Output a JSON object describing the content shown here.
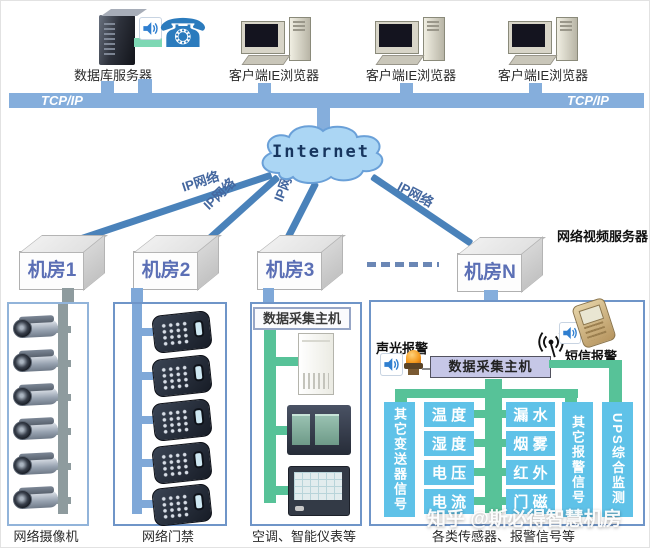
{
  "header": {
    "db_server_label": "数据库服务器",
    "client_label_1": "客户端IE浏览器",
    "client_label_2": "客户端IE浏览器",
    "client_label_3": "客户端IE浏览器",
    "tcpip_left": "TCP/IP",
    "tcpip_right": "TCP/IP"
  },
  "cloud": {
    "label": "Internet"
  },
  "ip_links": {
    "link1": "IP网络",
    "link2": "IP网络",
    "link3": "IP网络",
    "link4": "IP网络"
  },
  "rooms": {
    "room1": "机房1",
    "room2": "机房2",
    "room3": "机房3",
    "roomN": "机房N"
  },
  "nvr_label": "网络视频服务器",
  "camera_column": {
    "label": "网络摄像机"
  },
  "access_column": {
    "label": "网络门禁"
  },
  "collector_column": {
    "banner": "数据采集主机",
    "label": "空调、智能仪表等"
  },
  "sensor_panel": {
    "banner": "数据采集主机",
    "sound_alarm_label": "声光报警",
    "sms_alarm_label": "短信报警",
    "left_signal_label": "其它变送器信号",
    "right_signal_label": "其它报警信号",
    "ups_label": "UPS综合监测",
    "sensors_col1": [
      "温 度",
      "湿 度",
      "电 压",
      "电 流"
    ],
    "sensors_col2": [
      "漏 水",
      "烟 雾",
      "红 外",
      "门 磁"
    ],
    "label": "各类传感器、报警信号等"
  },
  "watermark": "知乎 @斯必得智慧机房",
  "colors": {
    "bus_blue": "#85aedc",
    "line_blue": "#4a82ba",
    "green_bus": "#57c298",
    "sensor_blue": "#5fc2e8",
    "lavender": "#c6c7e7",
    "gray_bus": "#8e9b9e",
    "room_text_blue": "#5b6fb5"
  }
}
